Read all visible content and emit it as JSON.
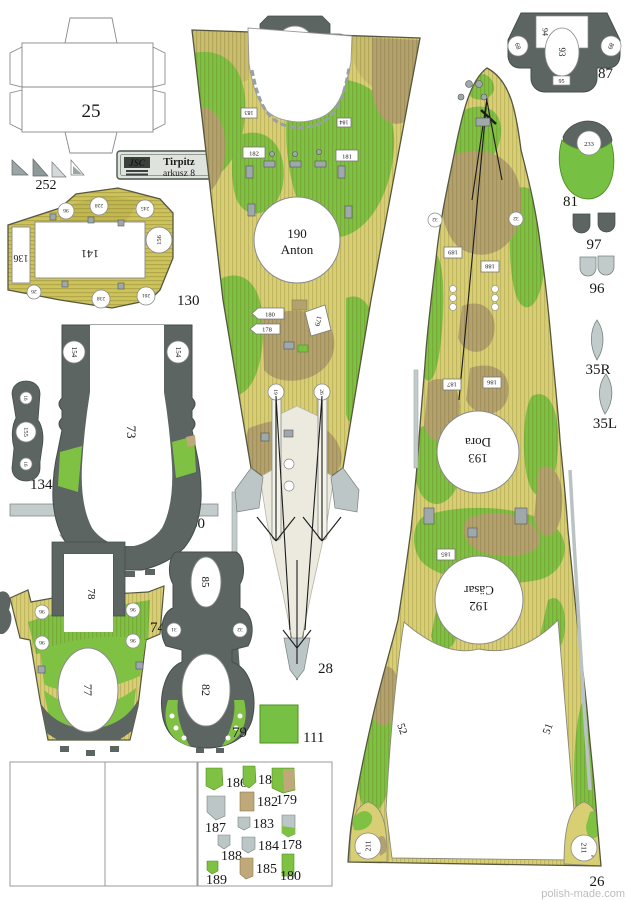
{
  "plate": {
    "logo": "JSC",
    "name": "Tirpitz",
    "sheet": "arkusz 8"
  },
  "watermark": "polish-made.com",
  "box25": {
    "label": "25"
  },
  "tri252": {
    "label": "252"
  },
  "deck130": {
    "label": "130",
    "win": "141",
    "winL": "136",
    "cR": "156",
    "t1": "96",
    "t2": "228",
    "t3": "245",
    "b1": "26",
    "b2": "238",
    "b3": "261"
  },
  "part134": {
    "label": "134",
    "mid": "155",
    "top": "16",
    "bot": "16"
  },
  "part73": {
    "label": "73",
    "cL": "154",
    "cR": "154"
  },
  "bar60": {
    "label": "60"
  },
  "part74": {
    "label": "74",
    "u": "78",
    "oval": "77",
    "c1": "96",
    "c2": "96",
    "c3": "96",
    "c4": "96"
  },
  "part79": {
    "label": "79",
    "ovalTop": "85",
    "oval": "82",
    "cL": "31",
    "cR": "32"
  },
  "part111": {
    "label": "111"
  },
  "part120": {
    "label": "120",
    "left": "122",
    "right": "122"
  },
  "part87": {
    "label": "87",
    "top": "94",
    "oval": "93",
    "bottom": "95",
    "left": "89",
    "right": "89"
  },
  "part81": {
    "label": "81",
    "circle": "233"
  },
  "part97": {
    "label": "97"
  },
  "part96": {
    "label": "96"
  },
  "part35R": {
    "label": "35R"
  },
  "part35L": {
    "label": "35L"
  },
  "deck28": {
    "label": "28",
    "turretNo": "190",
    "turretName": "Anton",
    "tagTL": "183",
    "tagTR": "184",
    "tagL": "182",
    "tagR": "181",
    "tag180": "180",
    "tag178": "178",
    "tag179": "179",
    "railL": "19",
    "railR": "26"
  },
  "deck26": {
    "label": "26",
    "doraNo": "193",
    "doraName": "Dora",
    "casarNo": "192",
    "casarName": "Cäsar",
    "tag189": "189",
    "tag188": "188",
    "tag187": "187",
    "tag186": "186",
    "tag185": "185",
    "fitL": "32",
    "fitR": "32",
    "edgeL": "52",
    "edgeR": "51",
    "tabL": "211",
    "tabLetL": "ℓ",
    "tabR": "211",
    "tabLetR": "e"
  },
  "legend": {
    "items": [
      {
        "label": "186"
      },
      {
        "label": "181"
      },
      {
        "label": "179"
      },
      {
        "label": "187"
      },
      {
        "label": "182"
      },
      {
        "label": "183"
      },
      {
        "label": "188"
      },
      {
        "label": "184"
      },
      {
        "label": "178"
      },
      {
        "label": "189"
      },
      {
        "label": "185"
      },
      {
        "label": "180"
      }
    ]
  }
}
